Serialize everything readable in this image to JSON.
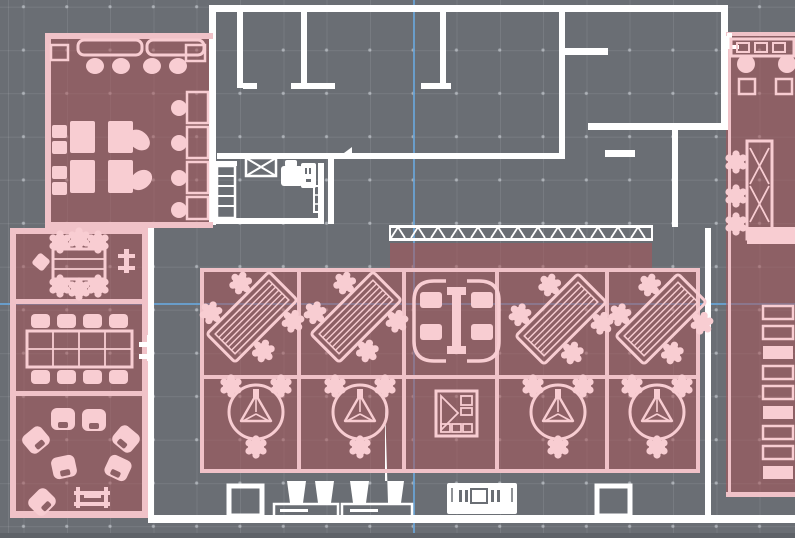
{
  "app": {
    "type": "floor-plan-cad-canvas",
    "description": "2D architectural office floor plan on a gray drafting grid; several rooms and the open-plan work zone are highlighted with a translucent red selection overlay; two light-blue cursor guides cross the canvas."
  },
  "canvas": {
    "width_px": 795,
    "height_px": 538,
    "grid_cell_px": 43,
    "cursor_guides": {
      "vertical_x_px": 413,
      "horizontal_y_px": 303
    }
  },
  "colors": {
    "bg": "#6a6e74",
    "grid-line": "rgba(255,255,255,0.09)",
    "grid-dot": "rgba(216,221,227,0.55)",
    "wall": "#ffffff",
    "pinkw": "#f0c2c8",
    "pinkf": "#f8cdd2",
    "overlay": "rgba(170,86,90,0.55)",
    "room-solid": "#8d6166",
    "guide": "#69a2d3",
    "edge": "#5e6268"
  },
  "rooms": [
    {
      "id": "break-room",
      "position": "top-left",
      "highlighted": true,
      "furniture": [
        "bar counter with 2 long tables",
        "4 bar stools",
        "2 corner side tables",
        "2 four-seat cafe tables",
        "2 loose chairs",
        "4 wall booths with round tables"
      ]
    },
    {
      "id": "copy-room",
      "position": "left of upper office block",
      "highlighted": false,
      "furniture": [
        "shelf rack",
        "crossed service box",
        "copier-printer",
        "narrow rack"
      ]
    },
    {
      "id": "office-top-left",
      "position": "top row",
      "highlighted": false,
      "furniture": []
    },
    {
      "id": "office-top-middle",
      "position": "top row",
      "highlighted": false,
      "furniture": []
    },
    {
      "id": "office-top-right",
      "position": "top row",
      "highlighted": false,
      "furniture": []
    },
    {
      "id": "interior-office",
      "position": "below corridor",
      "highlighted": false,
      "furniture": []
    },
    {
      "id": "meeting-room-small",
      "position": "left column top",
      "highlighted": true,
      "furniture": [
        "rectangular table",
        "6 chairs",
        "side chair",
        "wall stand"
      ]
    },
    {
      "id": "meeting-room-large",
      "position": "left column middle",
      "highlighted": true,
      "furniture": [
        "8-seat conference table",
        "wall-mounted unit"
      ]
    },
    {
      "id": "lounge",
      "position": "left column bottom",
      "highlighted": true,
      "furniture": [
        "7 armchairs in a circle",
        "slatted coffee bench"
      ]
    },
    {
      "id": "open-office",
      "position": "center",
      "highlighted": true,
      "furniture": [
        "4 angled bench-desk clusters (4 seats each)",
        "4 round team pods (3 seats each)",
        "enclosed meeting pod (4 seats)",
        "storage cabinet",
        "locker row"
      ]
    },
    {
      "id": "right-break-room",
      "position": "top-right",
      "highlighted": true,
      "furniture": [
        "counter with 3 modules",
        "2 round tables",
        "2 chairs"
      ]
    },
    {
      "id": "right-desk-room",
      "position": "right column",
      "highlighted": true,
      "furniture": [
        "L-shaped desk with hatching",
        "3 task chairs",
        "9 wall shelving units"
      ]
    }
  ],
  "service_strip_bottom": {
    "columns": 2,
    "waste_bins": 4,
    "credenza_segments": 2,
    "service_table": 1
  },
  "furniture_counts": {
    "desk_clusters": 4,
    "seats_per_cluster": 4,
    "team_pods": 4,
    "seats_per_pod": 3,
    "meeting_pods": 1,
    "lounge_chairs": 7
  }
}
